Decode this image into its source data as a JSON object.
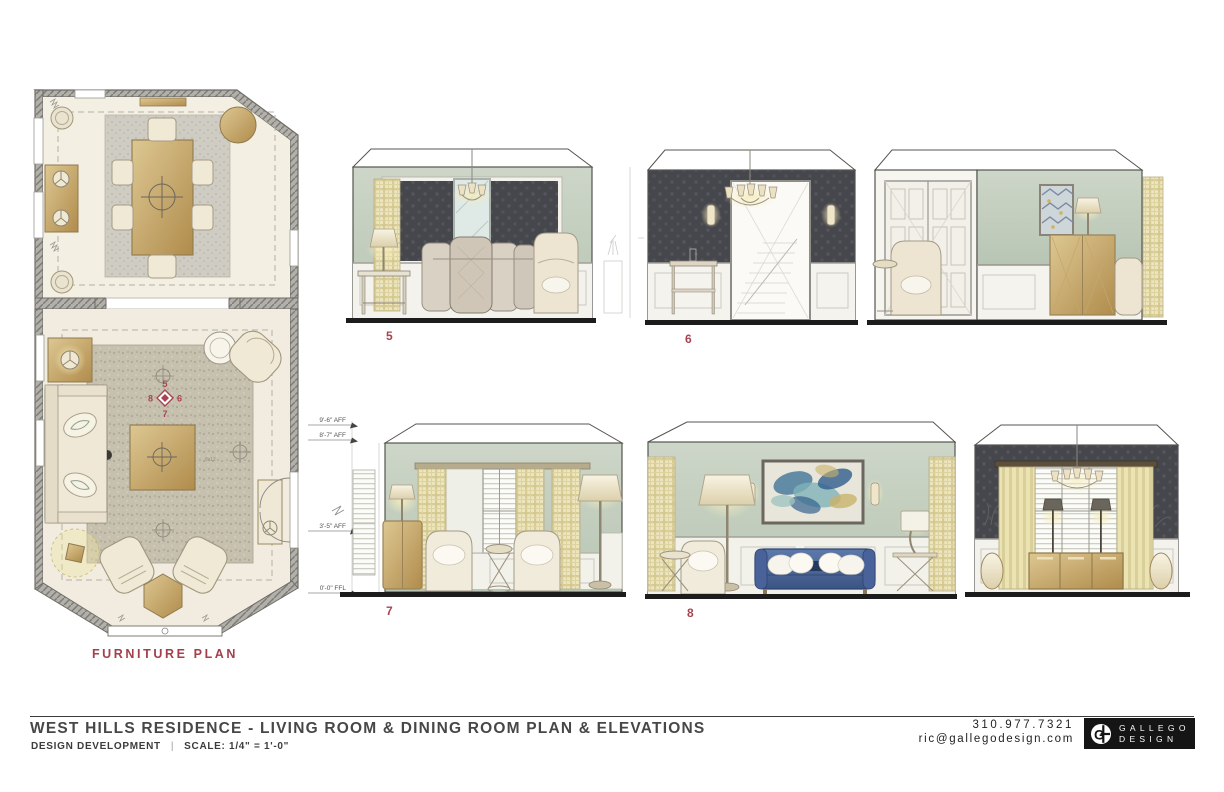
{
  "palette": {
    "wall_sage": "#c5cfc1",
    "wallpaper_charcoal": "#46474c",
    "wood_tan": "#c8a96e",
    "cream": "#f1ebdd",
    "sofa_blue": "#4d689b",
    "curtain_plaid": "#ece5bd",
    "rug_gray": "#c7c2b6",
    "accent_red": "#a84450",
    "ink": "#2b2b2b"
  },
  "plan": {
    "label": "FURNITURE PLAN",
    "living_rug_note": "8x12",
    "marker": {
      "top": "5",
      "right": "6",
      "bottom": "7",
      "left": "8"
    }
  },
  "elevations": [
    {
      "label": "5"
    },
    {
      "label": "6"
    },
    {
      "label": "7"
    },
    {
      "label": "8"
    }
  ],
  "heights": [
    "9'-6\" AFF",
    "8'-7\" AFF",
    "3'-5\" AFF",
    "0'-0\" FFL"
  ],
  "title_block": {
    "title": "WEST HILLS RESIDENCE - LIVING ROOM & DINING ROOM PLAN & ELEVATIONS",
    "phase": "DESIGN DEVELOPMENT",
    "divider": "|",
    "scale": "SCALE: 1/4\" = 1'-0\"",
    "phone": "310.977.7321",
    "email": "ric@gallegodesign.com",
    "logo_line1": "GALLEGO",
    "logo_line2": "DESIGN",
    "logo_monogram": "G"
  }
}
